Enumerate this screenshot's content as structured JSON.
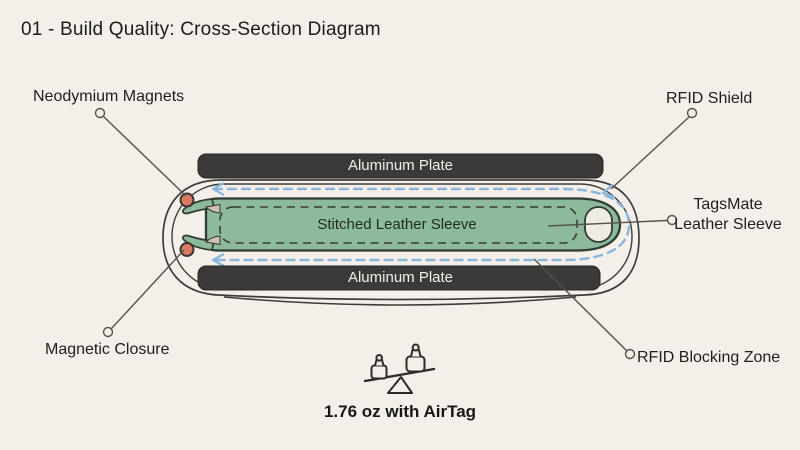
{
  "header": {
    "title": "01 - Build Quality: Cross-Section Diagram"
  },
  "diagram": {
    "labels": {
      "neodymium_magnets": "Neodymium Magnets",
      "rfid_shield": "RFID Shield",
      "tagsmate_line1": "TagsMate",
      "tagsmate_line2": "Leather Sleeve",
      "magnetic_closure": "Magnetic Closure",
      "rfid_blocking_zone": "RFID Blocking Zone",
      "aluminum_plate_top": "Aluminum Plate",
      "aluminum_plate_bottom": "Aluminum Plate",
      "stitched_leather_sleeve": "Stitched Leather Sleeve"
    },
    "weight_caption": "1.76 oz with AirTag",
    "icons": {
      "scale": "scale-icon",
      "flow_arrows": "rfid-flow-arrow-icon"
    },
    "colors": {
      "background": "#f4f0e9",
      "aluminum_plate": "#3b3a39",
      "plate_text": "#f2efe9",
      "sleeve_green": "#8cba9b",
      "magnet_coral": "#d97a61",
      "rfid_dash_blue": "#8ab5dc",
      "outline_ink": "#3f3c37",
      "label_text": "#1e1e1e"
    }
  }
}
